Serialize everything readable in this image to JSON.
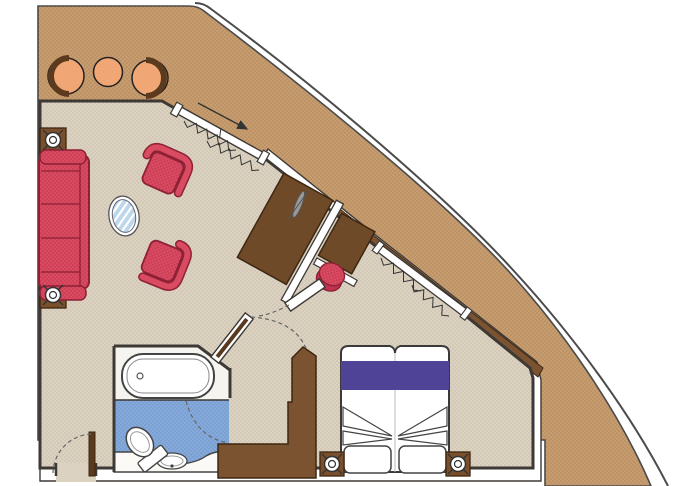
{
  "title": "suite-floor-plan",
  "colors": {
    "deck": "#C79D70",
    "deck_dot": "#B2885B",
    "hull_line": "#4B4B4B",
    "wall": "#3D3935",
    "floor": "#DBD2C2",
    "floor_dot": "#C8BBA5",
    "bath_floor": "#84A9DA",
    "bath_floor_dot": "#6E93C7",
    "bath_platform": "#F6F4EF",
    "sofa": "#D84B60",
    "sofa_dot": "#C03350",
    "sofa_line": "#8E2135",
    "balcony_chair": "#F1A775",
    "balcony_chair_back": "#5C3A1E",
    "furniture_brown": "#6E4A28",
    "furniture_brown_line": "#3E2712",
    "closet_brown": "#7B5331",
    "sill_brown": "#7B5331",
    "side_table_brown": "#7A4F2C",
    "bed_band": "#4E4397",
    "glass_blue": "#BCD7EB",
    "lamp_gray": "#999999",
    "door_leaf": "#5A3A1E",
    "arc_dash": "#666666"
  },
  "plan": {
    "rooms": [
      "balcony",
      "living-room",
      "desk-area",
      "bedroom",
      "bathroom",
      "entry-vestibule"
    ],
    "furniture": {
      "balcony": [
        "barrel-chair",
        "round-table",
        "barrel-chair"
      ],
      "living_room": [
        "three-seat-sofa",
        "armchair",
        "armchair",
        "oval-glass-table",
        "side-table",
        "side-table"
      ],
      "desk_area": [
        "tv-cabinet",
        "desk-return",
        "stool",
        "lamp"
      ],
      "bedroom": [
        "double-bed",
        "nightstand",
        "nightstand",
        "wardrobe"
      ],
      "bathroom": [
        "bathtub",
        "toilet",
        "sink-counter"
      ]
    },
    "symbols": [
      "sliding-door-arrow",
      "curtain-zigzag",
      "door-swing-arc",
      "circle-cross-fixture"
    ]
  }
}
